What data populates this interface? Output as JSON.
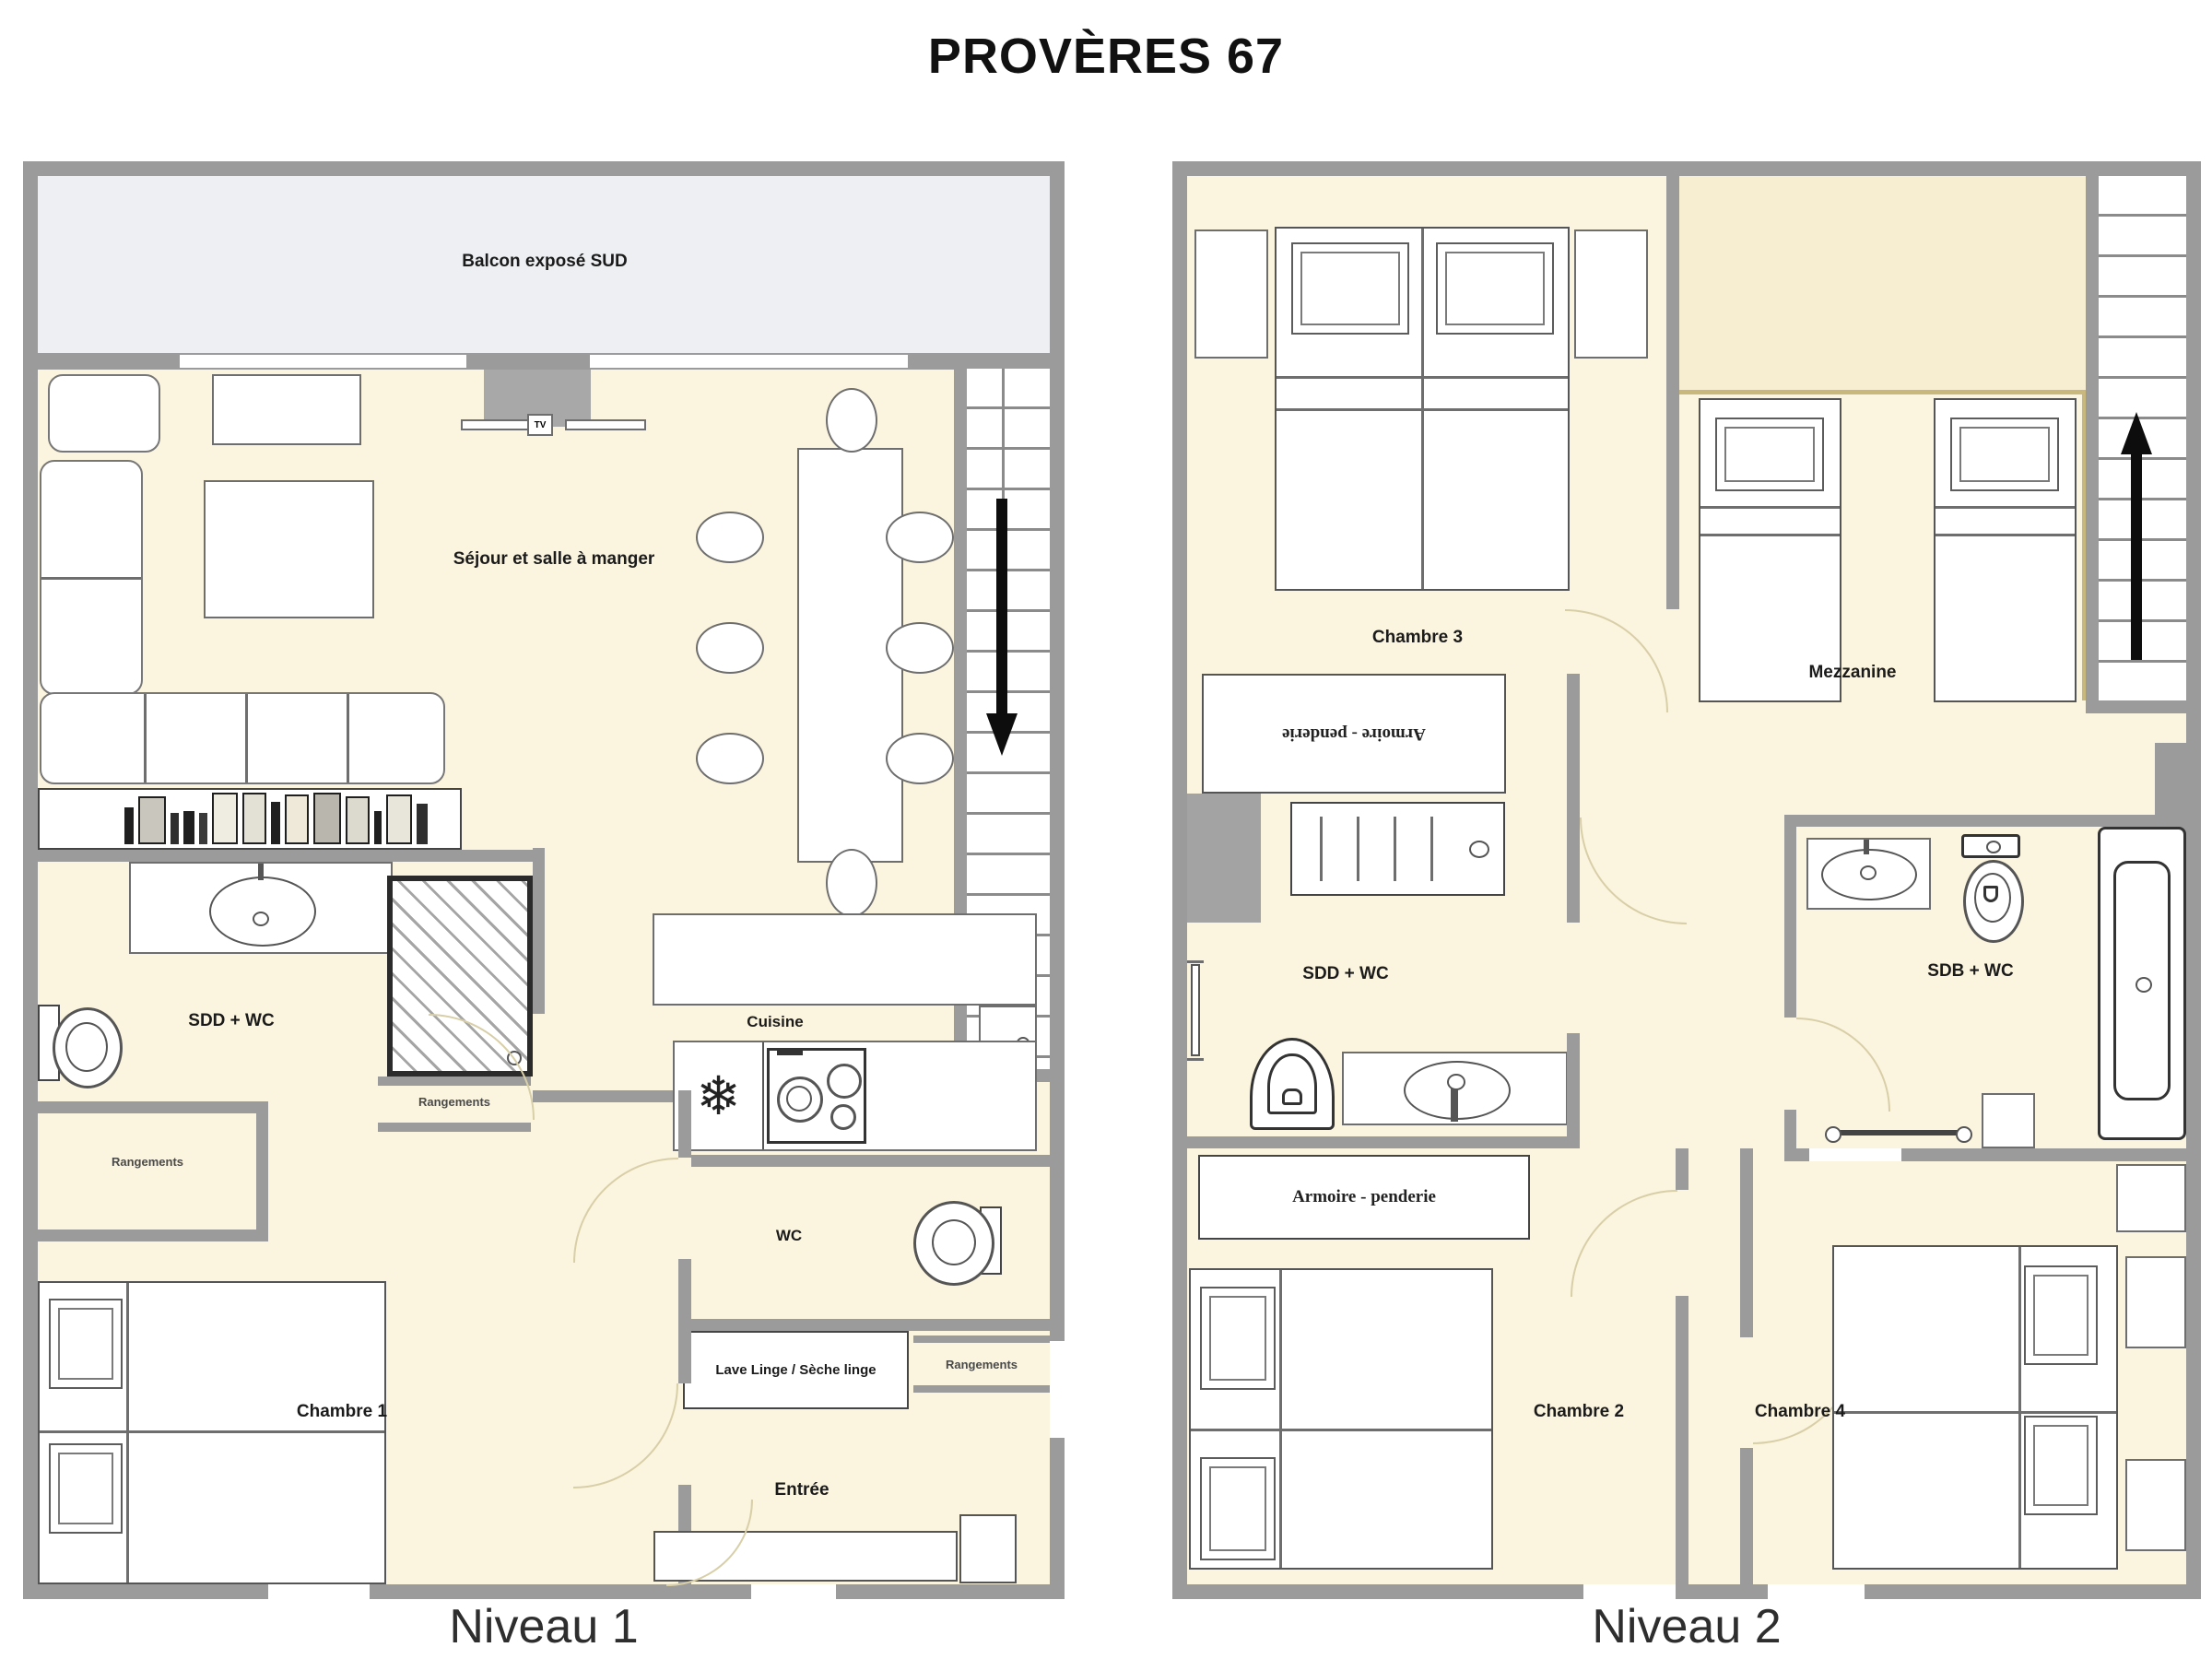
{
  "title": "PROVÈRES 67",
  "colors": {
    "floor": "#FBF4DE",
    "wall": "#9B9B9B",
    "balcony": "#EDEFF2",
    "mezzanine_floor": "#F7EED2",
    "accent_tan": "#C9B87E",
    "arrow": "#0D0D0D"
  },
  "niveau1": {
    "caption": "Niveau 1",
    "labels": {
      "balcony": "Balcon exposé SUD",
      "living": "Séjour et salle à manger",
      "tv": "TV",
      "kitchen": "Cuisine",
      "bathroom": "SDD + WC",
      "storage_left": "Rangements",
      "storage_shower": "Rangements",
      "storage_entry": "Rangements",
      "wc": "WC",
      "laundry": "Lave Linge / Sèche linge",
      "bedroom1": "Chambre 1",
      "entry": "Entrée"
    }
  },
  "niveau2": {
    "caption": "Niveau 2",
    "labels": {
      "bedroom3": "Chambre 3",
      "wardrobe_upper": "Armoire - penderie",
      "shower_room": "SDD + WC",
      "mezzanine": "Mezzanine",
      "bathroom": "SDB + WC",
      "wardrobe_lower": "Armoire - penderie",
      "bedroom2": "Chambre 2",
      "bedroom4": "Chambre 4"
    }
  }
}
